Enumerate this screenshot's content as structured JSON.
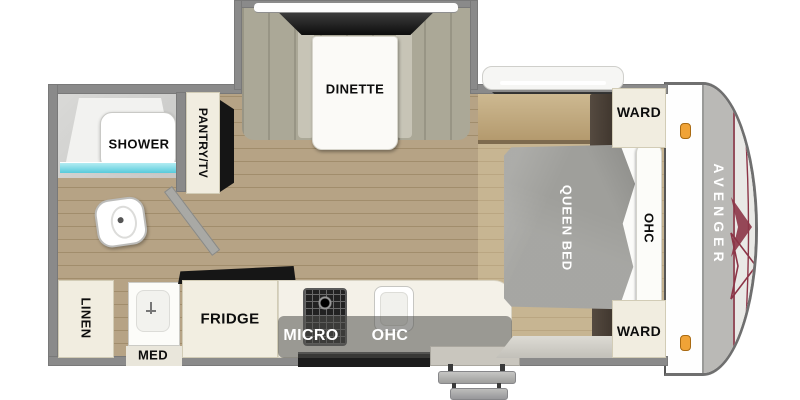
{
  "title": "Avenger travel trailer floor plan",
  "brand": "AVENGER",
  "labels": {
    "dinette": "DINETTE",
    "pantry_tv": "PANTRY/TV",
    "shower": "SHOWER",
    "linen": "LINEN",
    "med": "MED",
    "fridge": "FRIDGE",
    "micro": "MICRO",
    "kitchen_ohc": "OHC",
    "queen_bed": "QUEEN BED",
    "bed_ohc": "OHC",
    "ward_top": "WARD",
    "ward_bottom": "WARD"
  },
  "features": [
    "dinette-slideout-with-window",
    "shower",
    "toilet",
    "linen-cabinet",
    "medicine-cabinet-with-sink",
    "pantry-tv-cabinet",
    "refrigerator",
    "cooktop",
    "kitchen-sink",
    "overhead-microwave-cabinet",
    "queen-bed",
    "bed-overhead-cabinet",
    "two-wardrobes",
    "bedroom-window",
    "kitchen-window",
    "entry-door-with-two-steps",
    "front-cap-with-two-clearance-lights"
  ],
  "counts": {
    "entry_steps": 2,
    "clearance_lights": 2,
    "wardrobes": 2
  },
  "colors": {
    "wall_gray": "#8a8a8a",
    "floor_wood": "#b6a385",
    "cabinet_cream": "#f1ede0",
    "bench_gray": "#aba897",
    "mattress_gray": "#9f9f9b",
    "window_dark": "#1c1c1c",
    "shower_water": "#7fdce8",
    "clearance_light_orange": "#f0a337",
    "accent_maroon": "#8c3547",
    "cap_band_gray": "#bab9b6"
  }
}
